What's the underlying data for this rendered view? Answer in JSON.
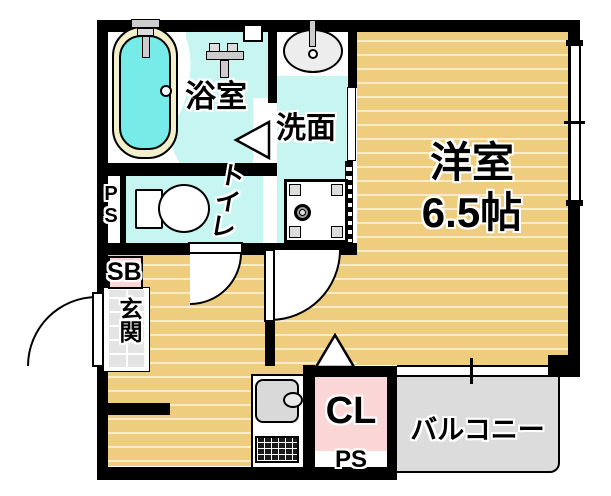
{
  "plan": {
    "bathroom_label": "浴室",
    "washroom_label": "洗面",
    "toilet_label": "トイレ",
    "western_room_label": "洋室",
    "western_room_size": "6.5帖",
    "entrance_label": "玄関",
    "shoe_box_label": "SB",
    "closet_label": "CL",
    "pipe_space_left_label": "PS",
    "pipe_space_bottom_label": "PS",
    "balcony_label": "バルコニー"
  },
  "fixtures": [
    "bathtub-icon",
    "bath-faucet-icon",
    "shower-mixer-icon",
    "bath-window",
    "washbasin-icon",
    "washing-machine-pan-icon",
    "toilet-icon",
    "kitchen-sink-icon",
    "gas-stove-icon",
    "door-swing-arc",
    "door-triangle",
    "sliding-window"
  ],
  "colors": {
    "wall_black": "#000000",
    "wood": "#eecd7e",
    "wood_stripe": "#f8ecca",
    "floor_cyan": "#c7f5f2",
    "tub_water": "#76ebe7",
    "tub_rim": "#f4efcb",
    "pink": "#fbd6d6",
    "balcony_gray": "#dcdcdc",
    "tile_gray": "#e4e4e4"
  }
}
